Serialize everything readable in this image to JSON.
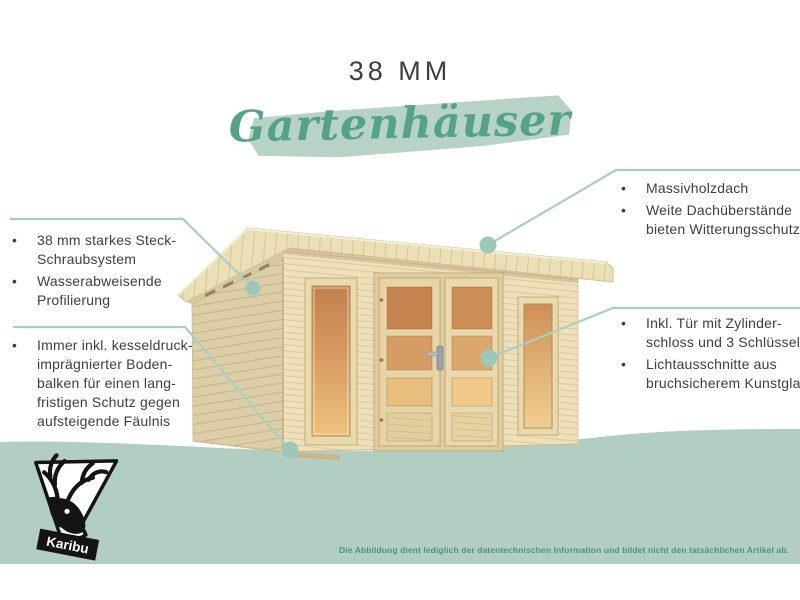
{
  "header": {
    "size_label": "38 MM",
    "category_label": "Gartenhäuser"
  },
  "bullet_glyph": "•",
  "callouts": {
    "left": [
      {
        "items": [
          {
            "lines": [
              "38 mm starkes Steck-",
              "Schraubsystem"
            ]
          },
          {
            "lines": [
              "Wasserabweisende",
              "Profilierung"
            ]
          }
        ]
      },
      {
        "items": [
          {
            "lines": [
              "Immer inkl. kesseldruck-",
              "imprägnierter Boden-",
              "balken für einen lang-",
              "fristigen Schutz gegen",
              "aufsteigende Fäulnis"
            ]
          }
        ]
      }
    ],
    "right": [
      {
        "items": [
          {
            "lines": [
              "Massivholzdach"
            ]
          },
          {
            "lines": [
              "Weite Dachüberstände",
              "bieten Witterungsschutz"
            ]
          }
        ]
      },
      {
        "items": [
          {
            "lines": [
              "Inkl. Tür mit Zylinder-",
              "schloss und 3 Schlüsseln"
            ]
          },
          {
            "lines": [
              "Lichtausschnitte aus",
              "bruchsicherem Kunstglas"
            ]
          }
        ]
      }
    ]
  },
  "illustration": {
    "subject": "wooden flat-roof garden house with double door and two windows"
  },
  "logo": {
    "label": "Karibu"
  },
  "footer": {
    "disclaimer": "Die Abbildung dient lediglich der datentechnischen Information und bildet nicht den tatsächlichen Artikel ab."
  },
  "colors": {
    "accent_green": "#56a287",
    "brush_green": "#b6d3c6",
    "band_green": "#b2cec3",
    "connector_line_green": "#a9cec2",
    "connector_dot_green": "#9dc8b9",
    "text_dark": "#3e3e40",
    "disclaimer_green": "#4e9379",
    "wall_front": "#eee0ba",
    "wall_side": "#dccfa8",
    "glass_amber_top": "#c2804d",
    "glass_amber_bottom": "#ecc27e"
  }
}
